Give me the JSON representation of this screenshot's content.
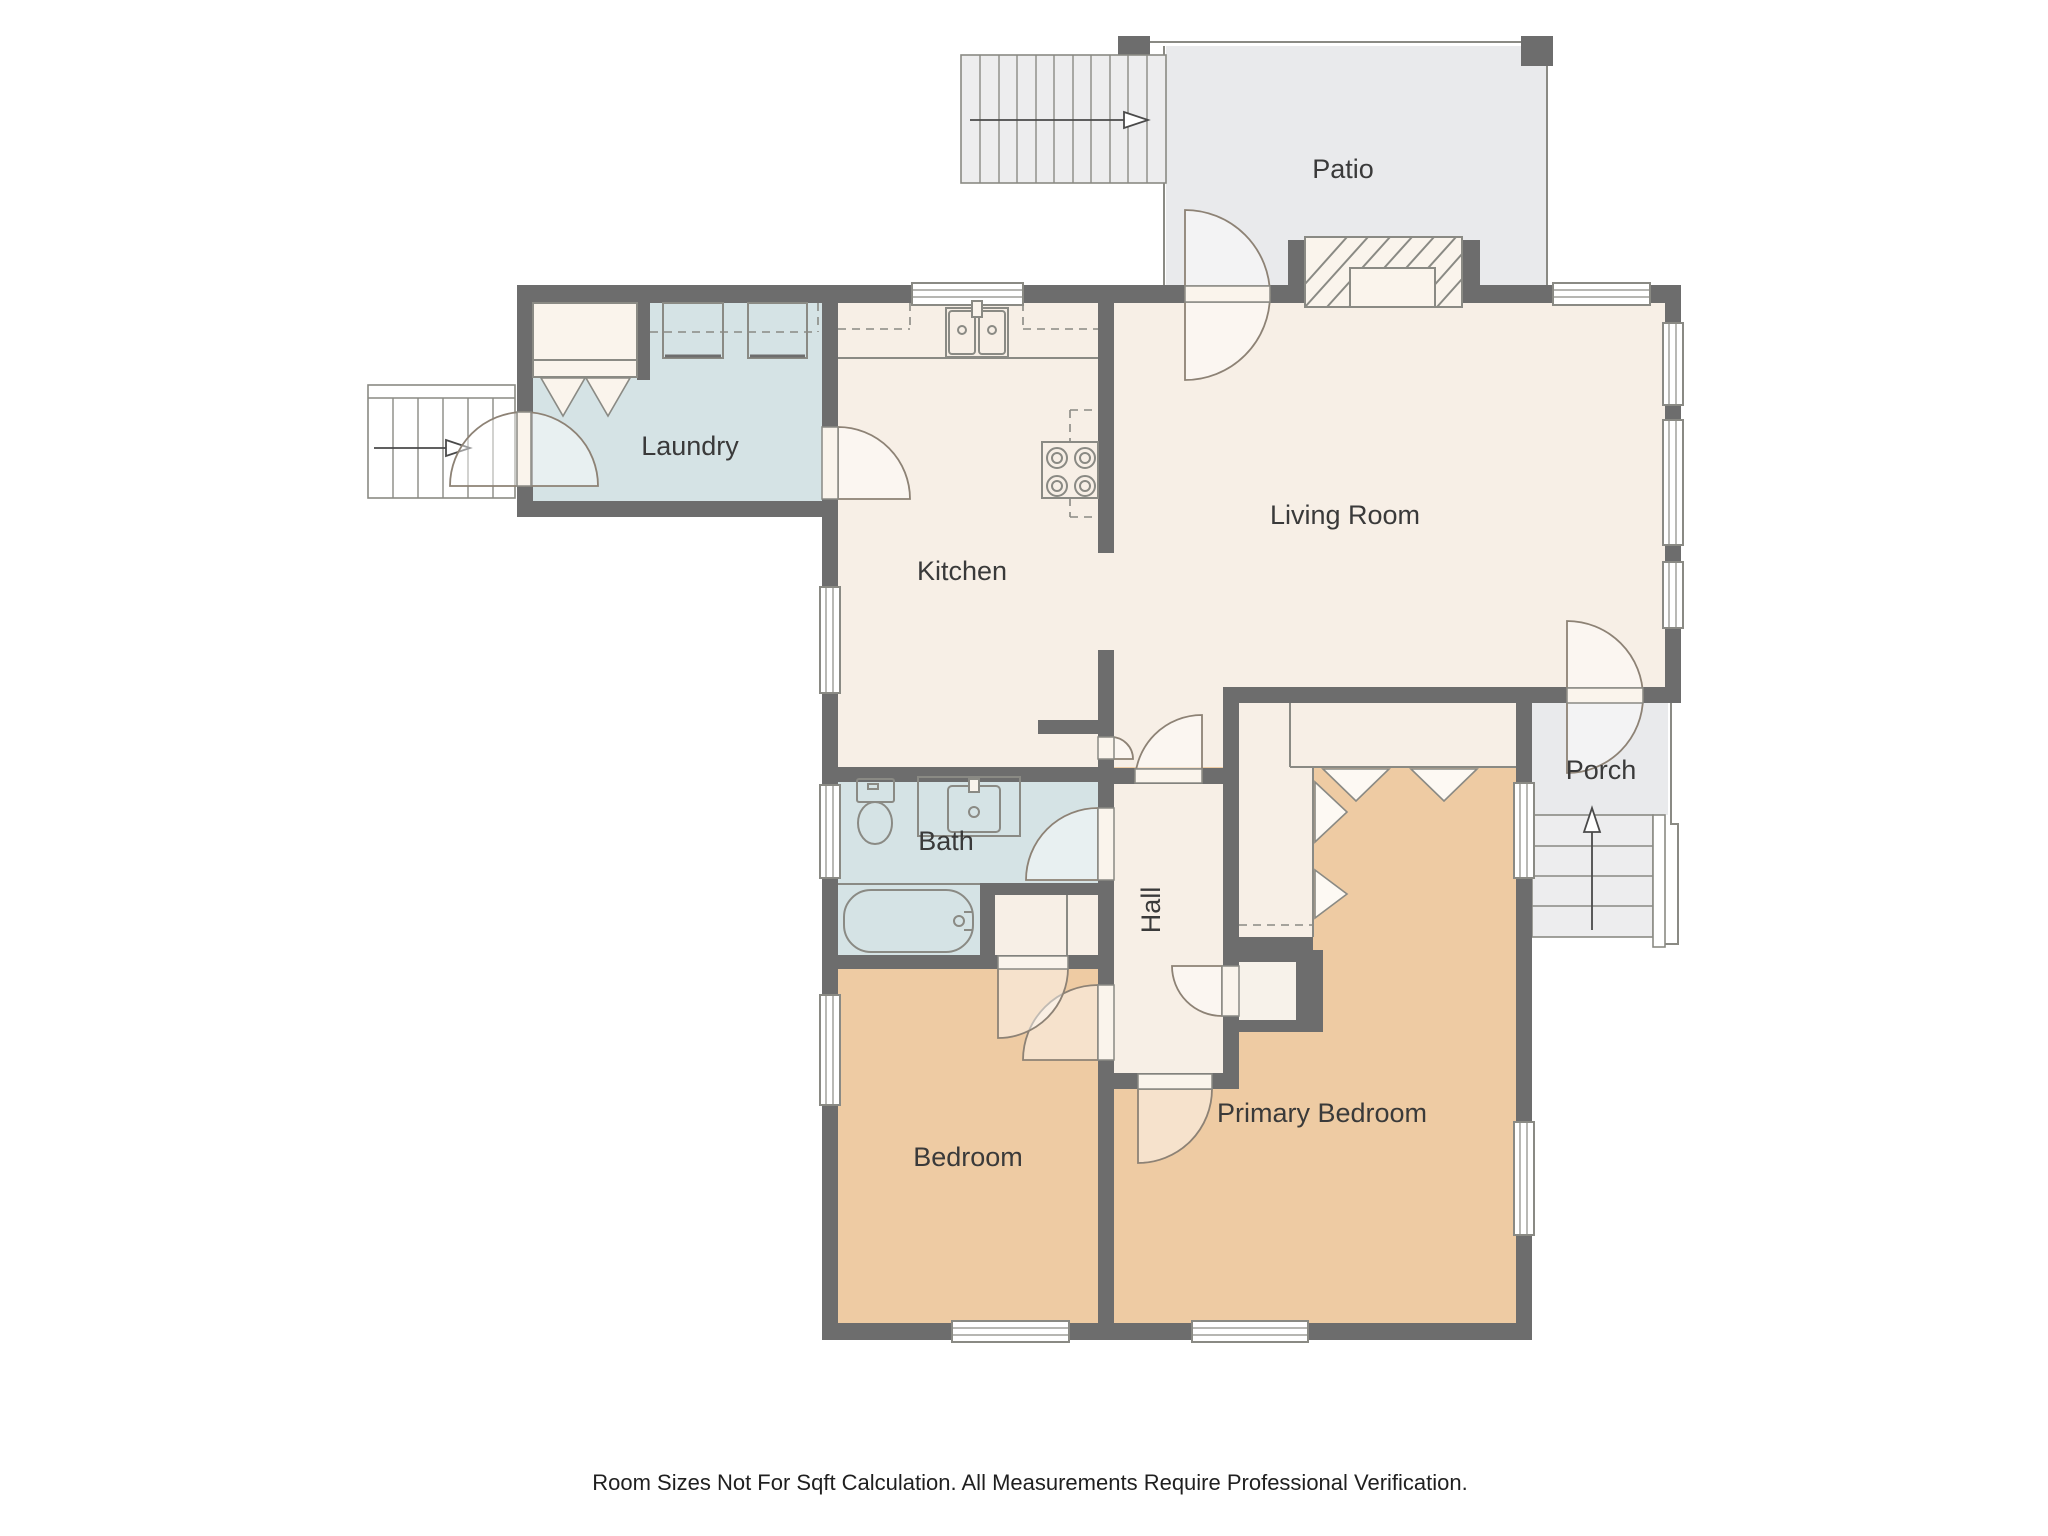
{
  "page": {
    "title": "Floor Plan",
    "disclaimer": "Room Sizes Not For Sqft Calculation. All Measurements Require Professional Verification."
  },
  "palette": {
    "wall": "#6d6d6d",
    "fixture": "#8a8a84",
    "door": "#8d8275",
    "labelc": "#3a3a3a",
    "cream": "#f7efe6",
    "blue": "#d5e3e5",
    "tan": "#eecba3",
    "outdoor": "#e9eaec",
    "stairf": "#ededee",
    "leaf": "#faf4ec",
    "winf": "#ffffff",
    "closet": "#f5ebe0"
  },
  "rooms": {
    "patio": {
      "label": "Patio"
    },
    "laundry": {
      "label": "Laundry"
    },
    "kitchen": {
      "label": "Kitchen"
    },
    "living_room": {
      "label": "Living Room"
    },
    "porch": {
      "label": "Porch"
    },
    "bath": {
      "label": "Bath"
    },
    "hall": {
      "label": "Hall"
    },
    "bedroom": {
      "label": "Bedroom"
    },
    "primary_bedroom": {
      "label": "Primary Bedroom"
    }
  },
  "fixtures": [
    "washer",
    "dryer",
    "kitchen-sink",
    "cooktop",
    "toilet",
    "vanity-sink",
    "bathtub",
    "fireplace",
    "closet"
  ],
  "stairs": [
    "exterior-stairs-top",
    "exterior-stairs-left",
    "porch-stairs"
  ]
}
